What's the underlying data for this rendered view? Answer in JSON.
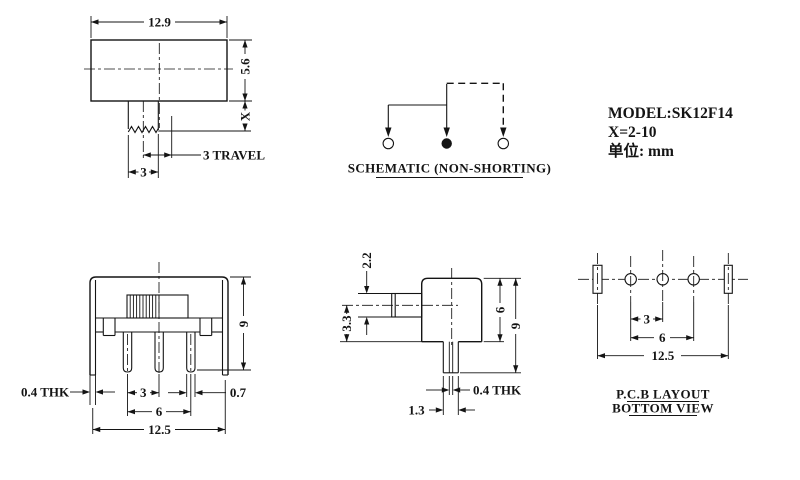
{
  "title_block": {
    "model": "MODEL:SK12F14",
    "x_range": "X=2-10",
    "unit": "单位: mm"
  },
  "top_view": {
    "width": "12.9",
    "height": "5.6",
    "stem_len": "X",
    "travel": "3 TRAVEL",
    "stem_width": "3"
  },
  "schematic": {
    "caption": "SCHEMATIC (NON-SHORTING)"
  },
  "front_view": {
    "total_height": "9",
    "tab_thickness": "0.4 THK",
    "pin_pitch": "3",
    "pin_width": "0.7",
    "pin_span": "6",
    "overall_width": "12.5"
  },
  "side_view": {
    "knob_height": "2.2",
    "knob_center": "3.3",
    "body_height": "6",
    "total_height": "9",
    "pin_thickness": "0.4 THK",
    "pin_width": "1.3"
  },
  "pcb_view": {
    "pitch": "3",
    "span": "6",
    "overall": "12.5",
    "caption_line1": "P.C.B LAYOUT",
    "caption_line2": "BOTTOM VIEW"
  }
}
